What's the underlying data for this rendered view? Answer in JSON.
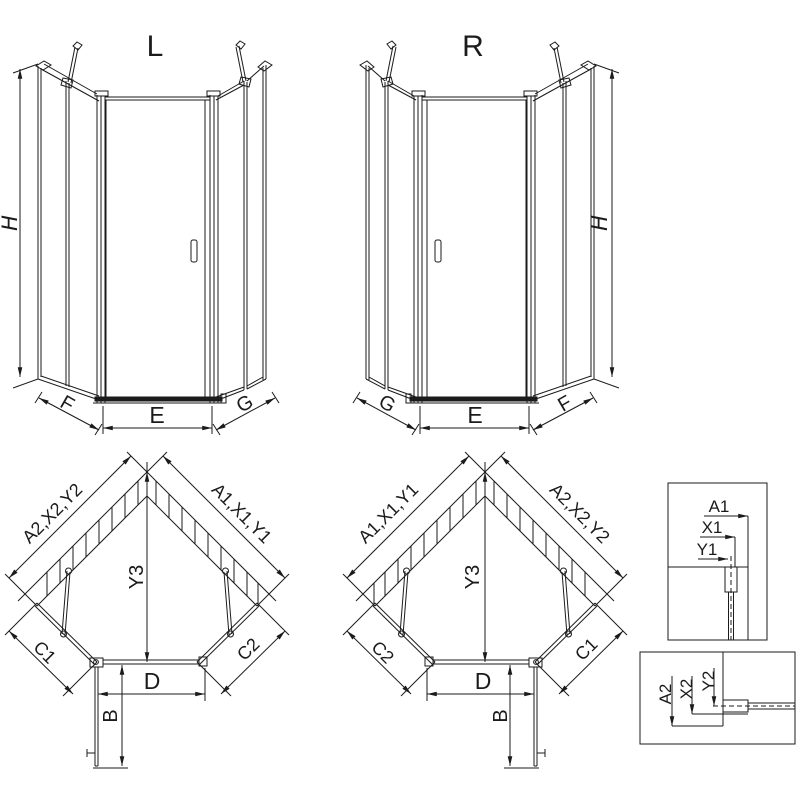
{
  "drawing_title": "Pentagonal shower enclosure installation diagram",
  "colors": {
    "line": "#1b1b1b",
    "background": "#ffffff"
  },
  "views": {
    "front_left": {
      "title": "L",
      "height_label": "H",
      "left_panel_label": "F",
      "door_width_label": "E",
      "right_panel_label": "G"
    },
    "front_right": {
      "title": "R",
      "height_label": "H",
      "left_panel_label": "G",
      "door_width_label": "E",
      "right_panel_label": "F"
    },
    "plan_left": {
      "left_wall_label": "A2,X2,Y2",
      "right_wall_label": "A1,X1,Y1",
      "depth_label": "Y3",
      "lower_left_label": "C1",
      "lower_right_label": "C2",
      "front_label": "D",
      "door_label": "B"
    },
    "plan_right": {
      "left_wall_label": "A1,X1,Y1",
      "right_wall_label": "A2,X2,Y2",
      "depth_label": "Y3",
      "lower_left_label": "C2",
      "lower_right_label": "C1",
      "front_label": "D",
      "door_label": "B"
    },
    "detail_top": {
      "labels": [
        "A1",
        "X1",
        "Y1"
      ]
    },
    "detail_bottom": {
      "labels": [
        "A2",
        "X2",
        "Y2"
      ]
    }
  }
}
